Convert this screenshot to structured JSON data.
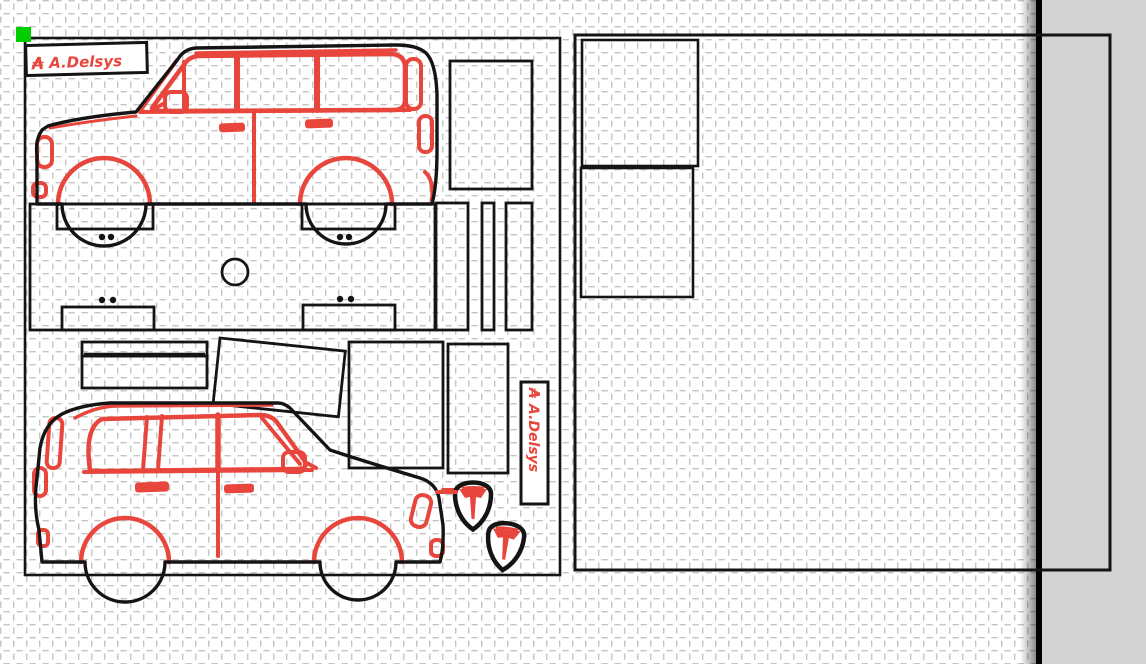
{
  "logo": {
    "symbol": "₳",
    "text": "A.Delsys"
  },
  "colors": {
    "accent_red": "#e8463c",
    "selection_green": "#00ce00",
    "pasteboard_gray": "#d2d2d2",
    "outline_black": "#141414",
    "grid_gray": "#c4c4c4",
    "mat_white": "#ffffff"
  },
  "canvas": {
    "sheet_count": 2,
    "pieces": {
      "left_sheet": [
        "car-side-view-upper",
        "chassis-floor-panel",
        "wheel-well-tabs",
        "rivet-dots",
        "fuel-cap-circle",
        "side-box-panel",
        "pillar-strip-wide",
        "pillar-strip-narrow",
        "pillar-strip-third",
        "bumper-strip-thin",
        "bumper-strip-wide",
        "tilted-panel",
        "door-panel",
        "rear-panel",
        "logo-plate-horizontal",
        "logo-plate-vertical",
        "badge-shield-upper",
        "badge-shield-lower",
        "car-side-view-lower"
      ],
      "right_sheet": [
        "box-panel-upper",
        "box-panel-lower"
      ]
    }
  }
}
